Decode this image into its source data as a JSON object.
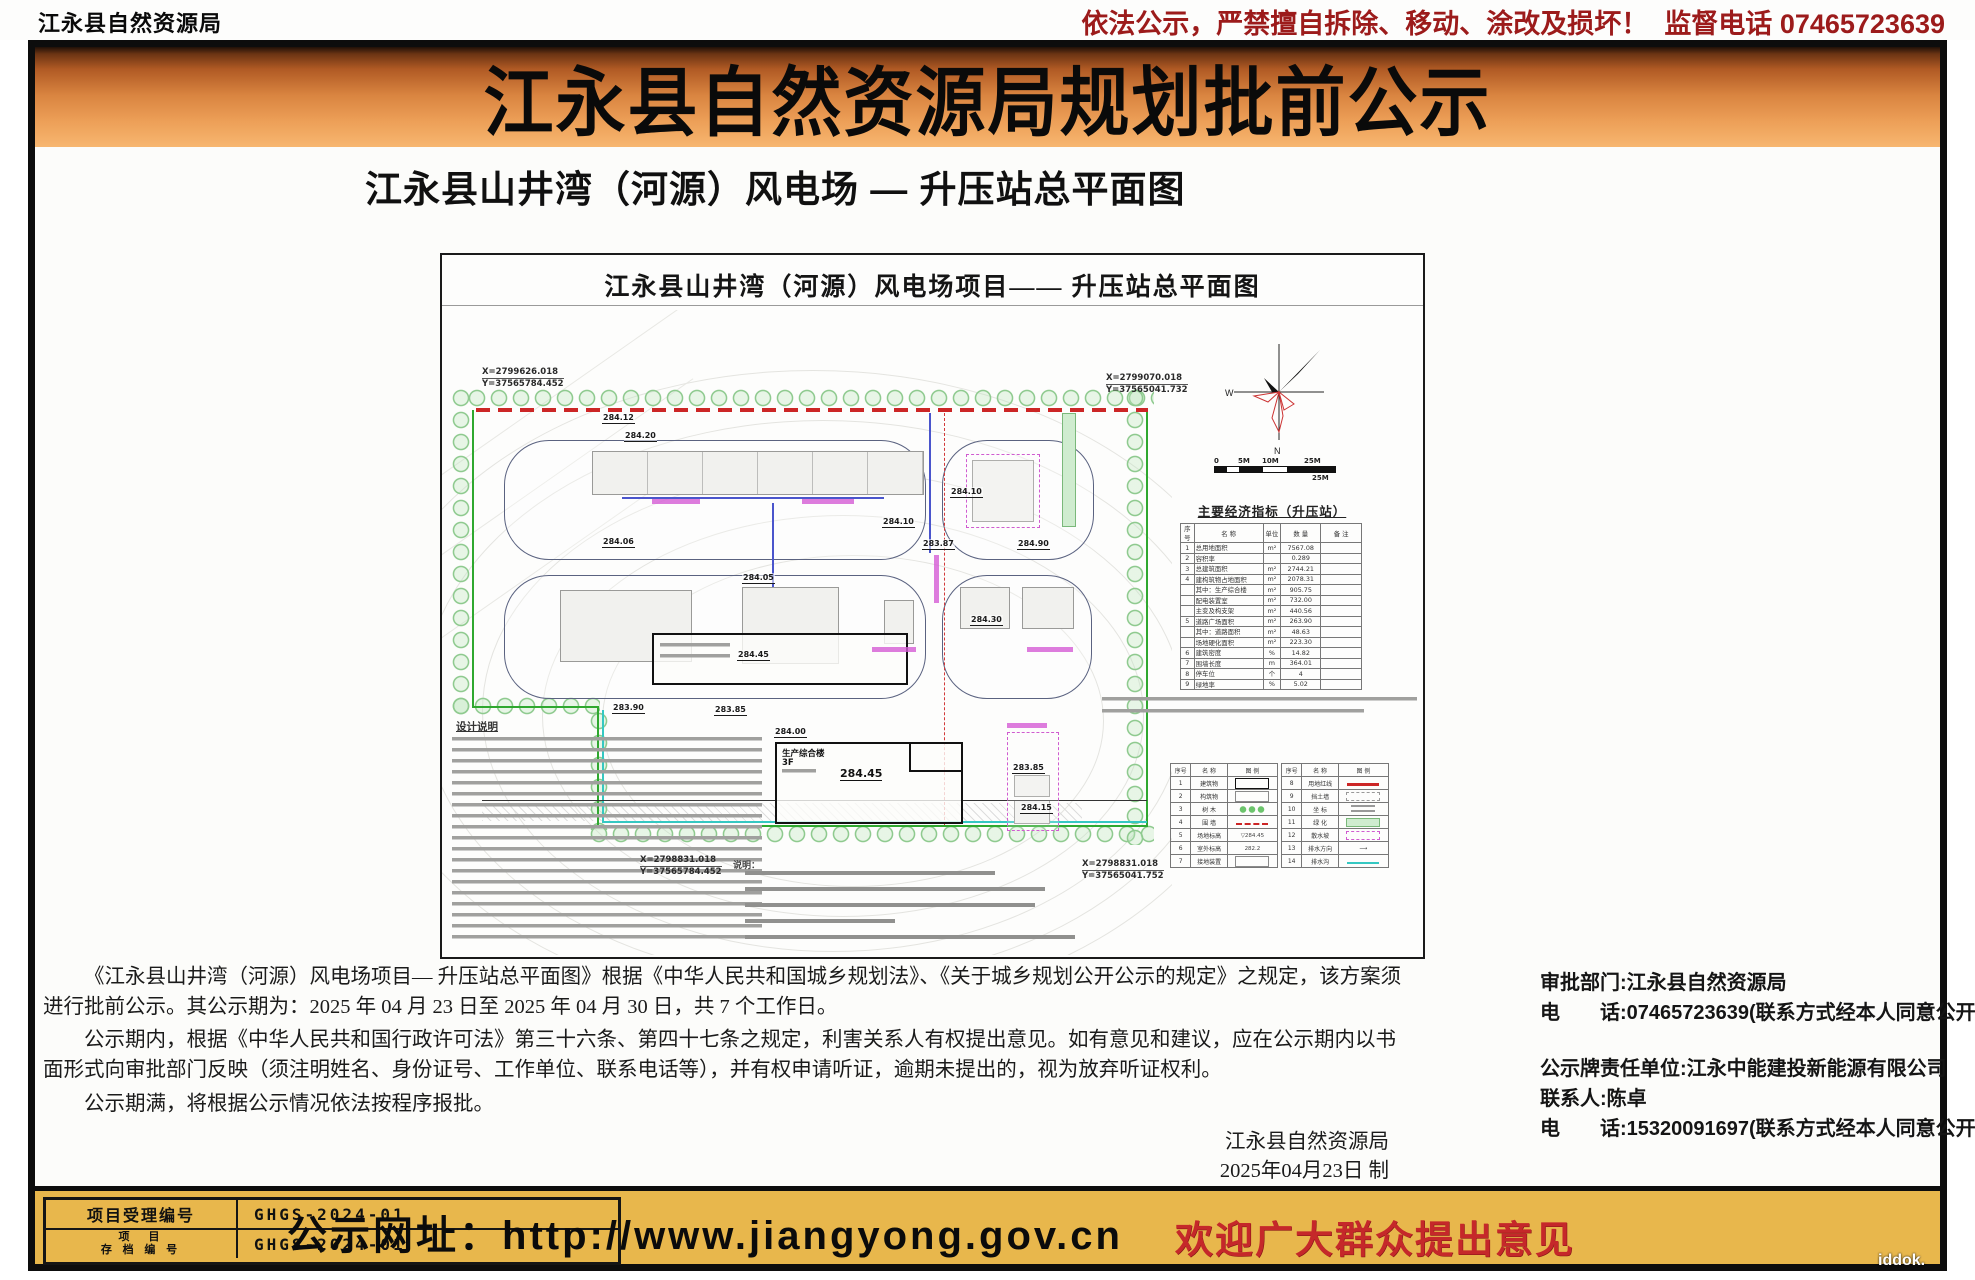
{
  "header": {
    "agency": "江永县自然资源局",
    "warning": "依法公示，严禁擅自拆除、移动、涂改及损坏！",
    "hotline": "监督电话 07465723639",
    "title": "江永县自然资源局规划批前公示",
    "subtitle": "江永县山井湾（河源）风电场 — 升压站总平面图"
  },
  "drawing": {
    "title": "江永县山井湾（河源）风电场项目—— 升压站总平面图",
    "compass": {
      "west": "W",
      "north": "N"
    },
    "scalebar": {
      "ticks": [
        "0",
        "5M",
        "10M",
        "25M"
      ],
      "end": "25M"
    },
    "corner_coords": {
      "top_left": [
        "X=2799626.018",
        "Y=37565784.452"
      ],
      "top_right": [
        "X=2799070.018",
        "Y=37565041.732"
      ],
      "bottom_left": [
        "X=2798831.018",
        "Y=37565784.452"
      ],
      "bottom_right": [
        "X=2798831.018",
        "Y=37565041.752"
      ]
    },
    "main_building": {
      "name": "生产综合楼",
      "floors": "3F",
      "elevation": "284.45"
    },
    "elevations": [
      {
        "x": 160,
        "y": 158,
        "v": "284.12"
      },
      {
        "x": 182,
        "y": 176,
        "v": "284.20"
      },
      {
        "x": 508,
        "y": 232,
        "v": "284.10"
      },
      {
        "x": 440,
        "y": 262,
        "v": "284.10"
      },
      {
        "x": 160,
        "y": 282,
        "v": "284.06"
      },
      {
        "x": 480,
        "y": 284,
        "v": "283.87"
      },
      {
        "x": 575,
        "y": 284,
        "v": "284.90"
      },
      {
        "x": 300,
        "y": 318,
        "v": "284.05"
      },
      {
        "x": 528,
        "y": 360,
        "v": "284.30"
      },
      {
        "x": 295,
        "y": 395,
        "v": "284.45"
      },
      {
        "x": 332,
        "y": 472,
        "v": "284.00"
      },
      {
        "x": 170,
        "y": 448,
        "v": "283.90"
      },
      {
        "x": 272,
        "y": 450,
        "v": "283.85"
      },
      {
        "x": 570,
        "y": 508,
        "v": "283.85"
      },
      {
        "x": 578,
        "y": 548,
        "v": "284.15"
      }
    ],
    "econ_table": {
      "title": "主要经济指标（升压站）",
      "columns": [
        "序号",
        "名  称",
        "单位",
        "数  量",
        "备 注"
      ],
      "rows": [
        {
          "no": "1",
          "name": "总用地面积",
          "unit": "m²",
          "qty": "7567.08",
          "note": ""
        },
        {
          "no": "2",
          "name": "容积率",
          "unit": "",
          "qty": "0.289",
          "note": ""
        },
        {
          "no": "3",
          "name": "总建筑面积",
          "unit": "m²",
          "qty": "2744.21",
          "note": ""
        },
        {
          "no": "4",
          "name": "建构筑物占地面积",
          "unit": "m²",
          "qty": "2078.31",
          "note": ""
        },
        {
          "no": "",
          "name": "其中：生产综合楼",
          "unit": "m²",
          "qty": "905.75",
          "note": ""
        },
        {
          "no": "",
          "name": "配电装置室",
          "unit": "m²",
          "qty": "732.00",
          "note": ""
        },
        {
          "no": "",
          "name": "主变及构支架",
          "unit": "m²",
          "qty": "440.56",
          "note": ""
        },
        {
          "no": "5",
          "name": "道路广场面积",
          "unit": "m²",
          "qty": "263.90",
          "note": ""
        },
        {
          "no": "",
          "name": "其中：道路面积",
          "unit": "m²",
          "qty": "48.63",
          "note": ""
        },
        {
          "no": "",
          "name": "场地硬化面积",
          "unit": "m²",
          "qty": "223.30",
          "note": ""
        },
        {
          "no": "6",
          "name": "建筑密度",
          "unit": "%",
          "qty": "14.82",
          "note": ""
        },
        {
          "no": "7",
          "name": "围墙长度",
          "unit": "m",
          "qty": "364.01",
          "note": ""
        },
        {
          "no": "8",
          "name": "停车位",
          "unit": "个",
          "qty": "4",
          "note": ""
        },
        {
          "no": "9",
          "name": "绿地率",
          "unit": "%",
          "qty": "5.02",
          "note": ""
        }
      ]
    },
    "legend": {
      "columns": [
        "序号",
        "名  称",
        "图  例"
      ],
      "left": [
        {
          "no": "1",
          "name": "建筑物",
          "sym": "rect",
          "symtext": ""
        },
        {
          "no": "2",
          "name": "构筑物",
          "sym": "rect2",
          "symtext": ""
        },
        {
          "no": "3",
          "name": "树  木",
          "sym": "tree",
          "symtext": ""
        },
        {
          "no": "4",
          "name": "围  墙",
          "sym": "reddash",
          "symtext": ""
        },
        {
          "no": "5",
          "name": "场地标高",
          "sym": "blank",
          "symtext": "▽284.45"
        },
        {
          "no": "6",
          "name": "室外标高",
          "sym": "blank",
          "symtext": "282.2"
        },
        {
          "no": "7",
          "name": "接地装置",
          "sym": "rect2",
          "symtext": ""
        }
      ],
      "right": [
        {
          "no": "8",
          "name": "用地红线",
          "sym": "redline",
          "symtext": ""
        },
        {
          "no": "9",
          "name": "挡土墙",
          "sym": "graydash",
          "symtext": ""
        },
        {
          "no": "10",
          "name": "坐  标",
          "sym": "coord",
          "symtext": ""
        },
        {
          "no": "11",
          "name": "绿  化",
          "sym": "greenrect",
          "symtext": ""
        },
        {
          "no": "12",
          "name": "散水坡",
          "sym": "pinkdash",
          "symtext": ""
        },
        {
          "no": "13",
          "name": "排水方向",
          "sym": "blank",
          "symtext": "⟶"
        },
        {
          "no": "14",
          "name": "排水沟",
          "sym": "cyanline",
          "symtext": ""
        }
      ]
    },
    "notes_title": "设计说明",
    "notes2_label": "说明："
  },
  "body": {
    "p1": "《江永县山井湾（河源）风电场项目— 升压站总平面图》根据《中华人民共和国城乡规划法》、《关于城乡规划公开公示的规定》之规定，该方案须进行批前公示。其公示期为：2025 年 04 月 23 日至 2025 年 04 月 30 日，共 7 个工作日。",
    "p2": "公示期内，根据《中华人民共和国行政许可法》第三十六条、第四十七条之规定，利害关系人有权提出意见。如有意见和建议，应在公示期内以书面形式向审批部门反映（须注明姓名、身份证号、工作单位、联系电话等），并有权申请听证，逾期未提出的，视为放弃听证权利。",
    "p3": "公示期满，将根据公示情况依法按程序报批。",
    "signature": "江永县自然资源局",
    "date": "2025年04月23日  制"
  },
  "contacts": {
    "approval_dept": "审批部门:江永县自然资源局",
    "phone1": "电　　话:07465723639(联系方式经本人同意公开)",
    "responsible_unit": "公示牌责任单位:江永中能建投新能源有限公司",
    "contact_person": "联系人:陈卓",
    "phone2": "电　　话:15320091697(联系方式经本人同意公开)"
  },
  "footer": {
    "box": {
      "row1": {
        "label": "项目受理编号",
        "value": "GHGS-2024-01"
      },
      "row2": {
        "label_l1": "项　目",
        "label_l2": "存 档 编 号",
        "value": "GHGS-2024-01"
      }
    },
    "url": "公示网址：http://www.jiangyong.gov.cn",
    "slogan": "欢迎广大群众提出意见"
  },
  "watermark": "iddok.",
  "colors": {
    "banner_orange": "#d98440",
    "footer_gold": "#e8b74c",
    "slogan_red": "#c5282a",
    "warning_red": "#9c1b1b",
    "boundary_green": "#2fa82f",
    "redline": "#cc2626"
  }
}
